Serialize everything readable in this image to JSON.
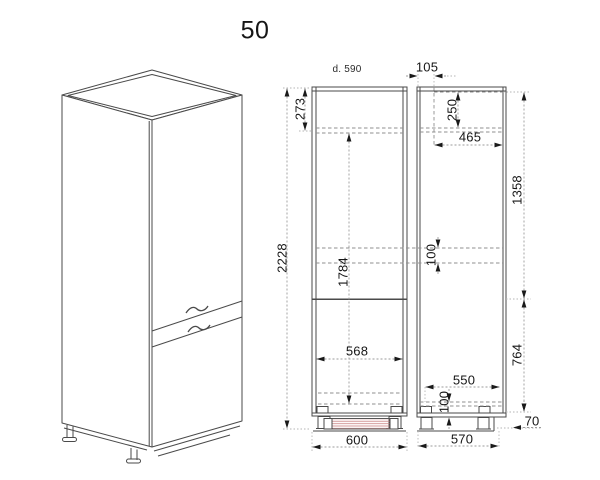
{
  "drawing": {
    "title": "50",
    "hatch_color": "#c98080",
    "line_color": "#4a4a4a",
    "front_section": {
      "depth_label": "d. 590",
      "total_height": "2228",
      "top_offset": "273",
      "niche_height": "1784",
      "interior_width": "568",
      "overall_width": "600",
      "rail_height": "100"
    },
    "side_section": {
      "front_inset": "105",
      "top_recess": "250",
      "interior_depth": "465",
      "upper_height": "1358",
      "lower_height": "764",
      "shelf_depth": "550",
      "rail_height": "100",
      "base_depth": "570",
      "plinth_height": "70"
    }
  }
}
